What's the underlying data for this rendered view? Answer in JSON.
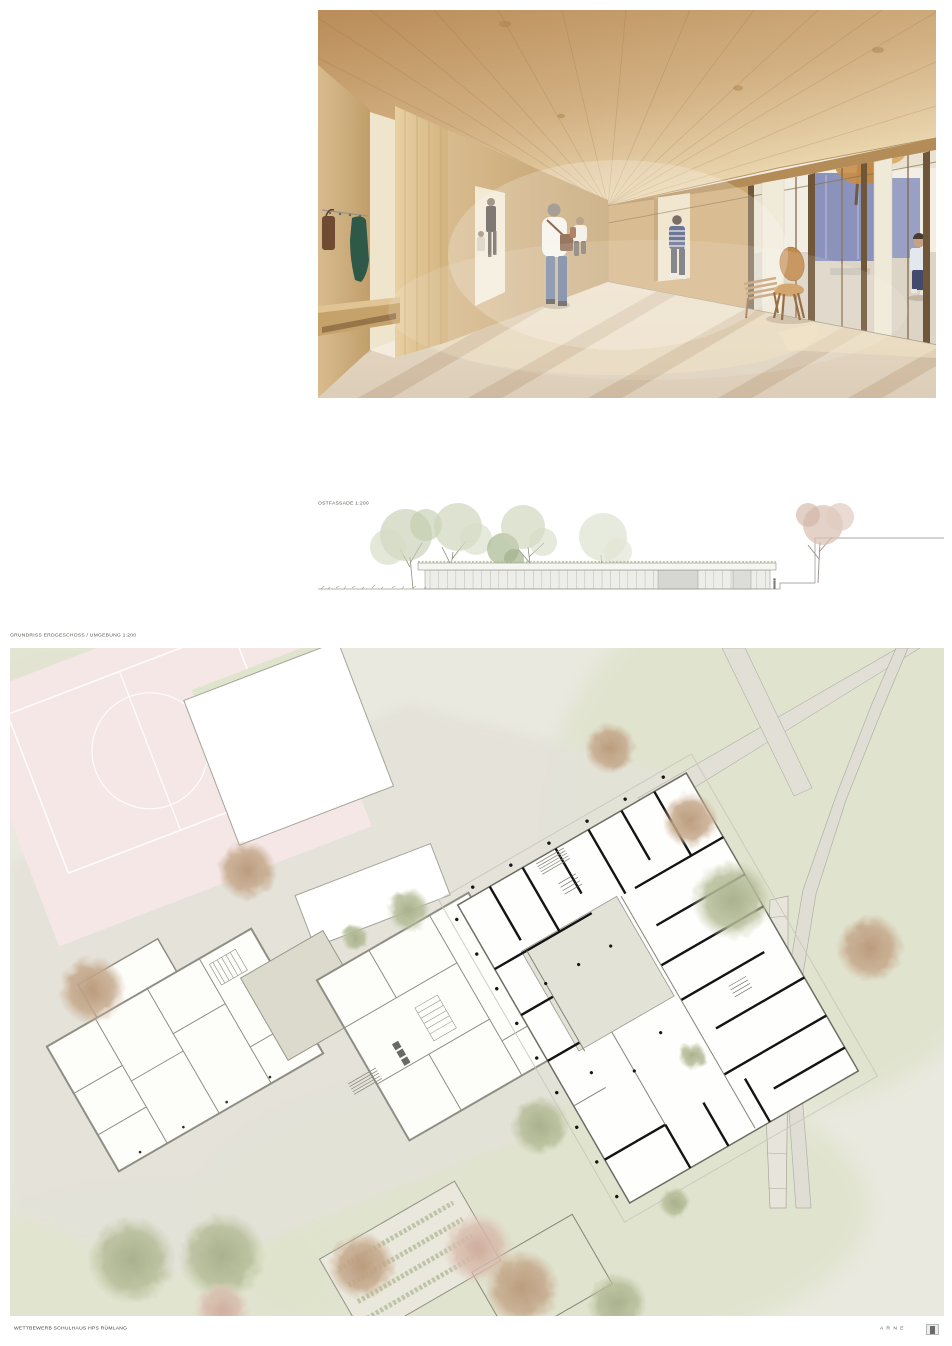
{
  "labels": {
    "elevation": "OSTFASSADE 1:200",
    "siteplan": "GRUNDRISS ERDGESCHOSS / UMGEBUNG 1:200"
  },
  "footer": {
    "project": "WETTBEWERB SCHULHAUS HPS RÜMLANG",
    "author": "A R N E"
  },
  "colors": {
    "wood": "#c9a876",
    "floor": "#ddd2c0",
    "courtyard_blue": "#8b93bd",
    "coat_green": "#2e5948",
    "field_pink": "#f6e7e7",
    "lawn_green": "#dfe3cc",
    "paving_gray": "#e4e2d9",
    "plan_wall_black": "#161616",
    "plan_wall_gray": "#8f8e85",
    "tree_green": "#b3ba96",
    "tree_brown": "#c0a284",
    "tree_pink": "#d6b6a8"
  }
}
